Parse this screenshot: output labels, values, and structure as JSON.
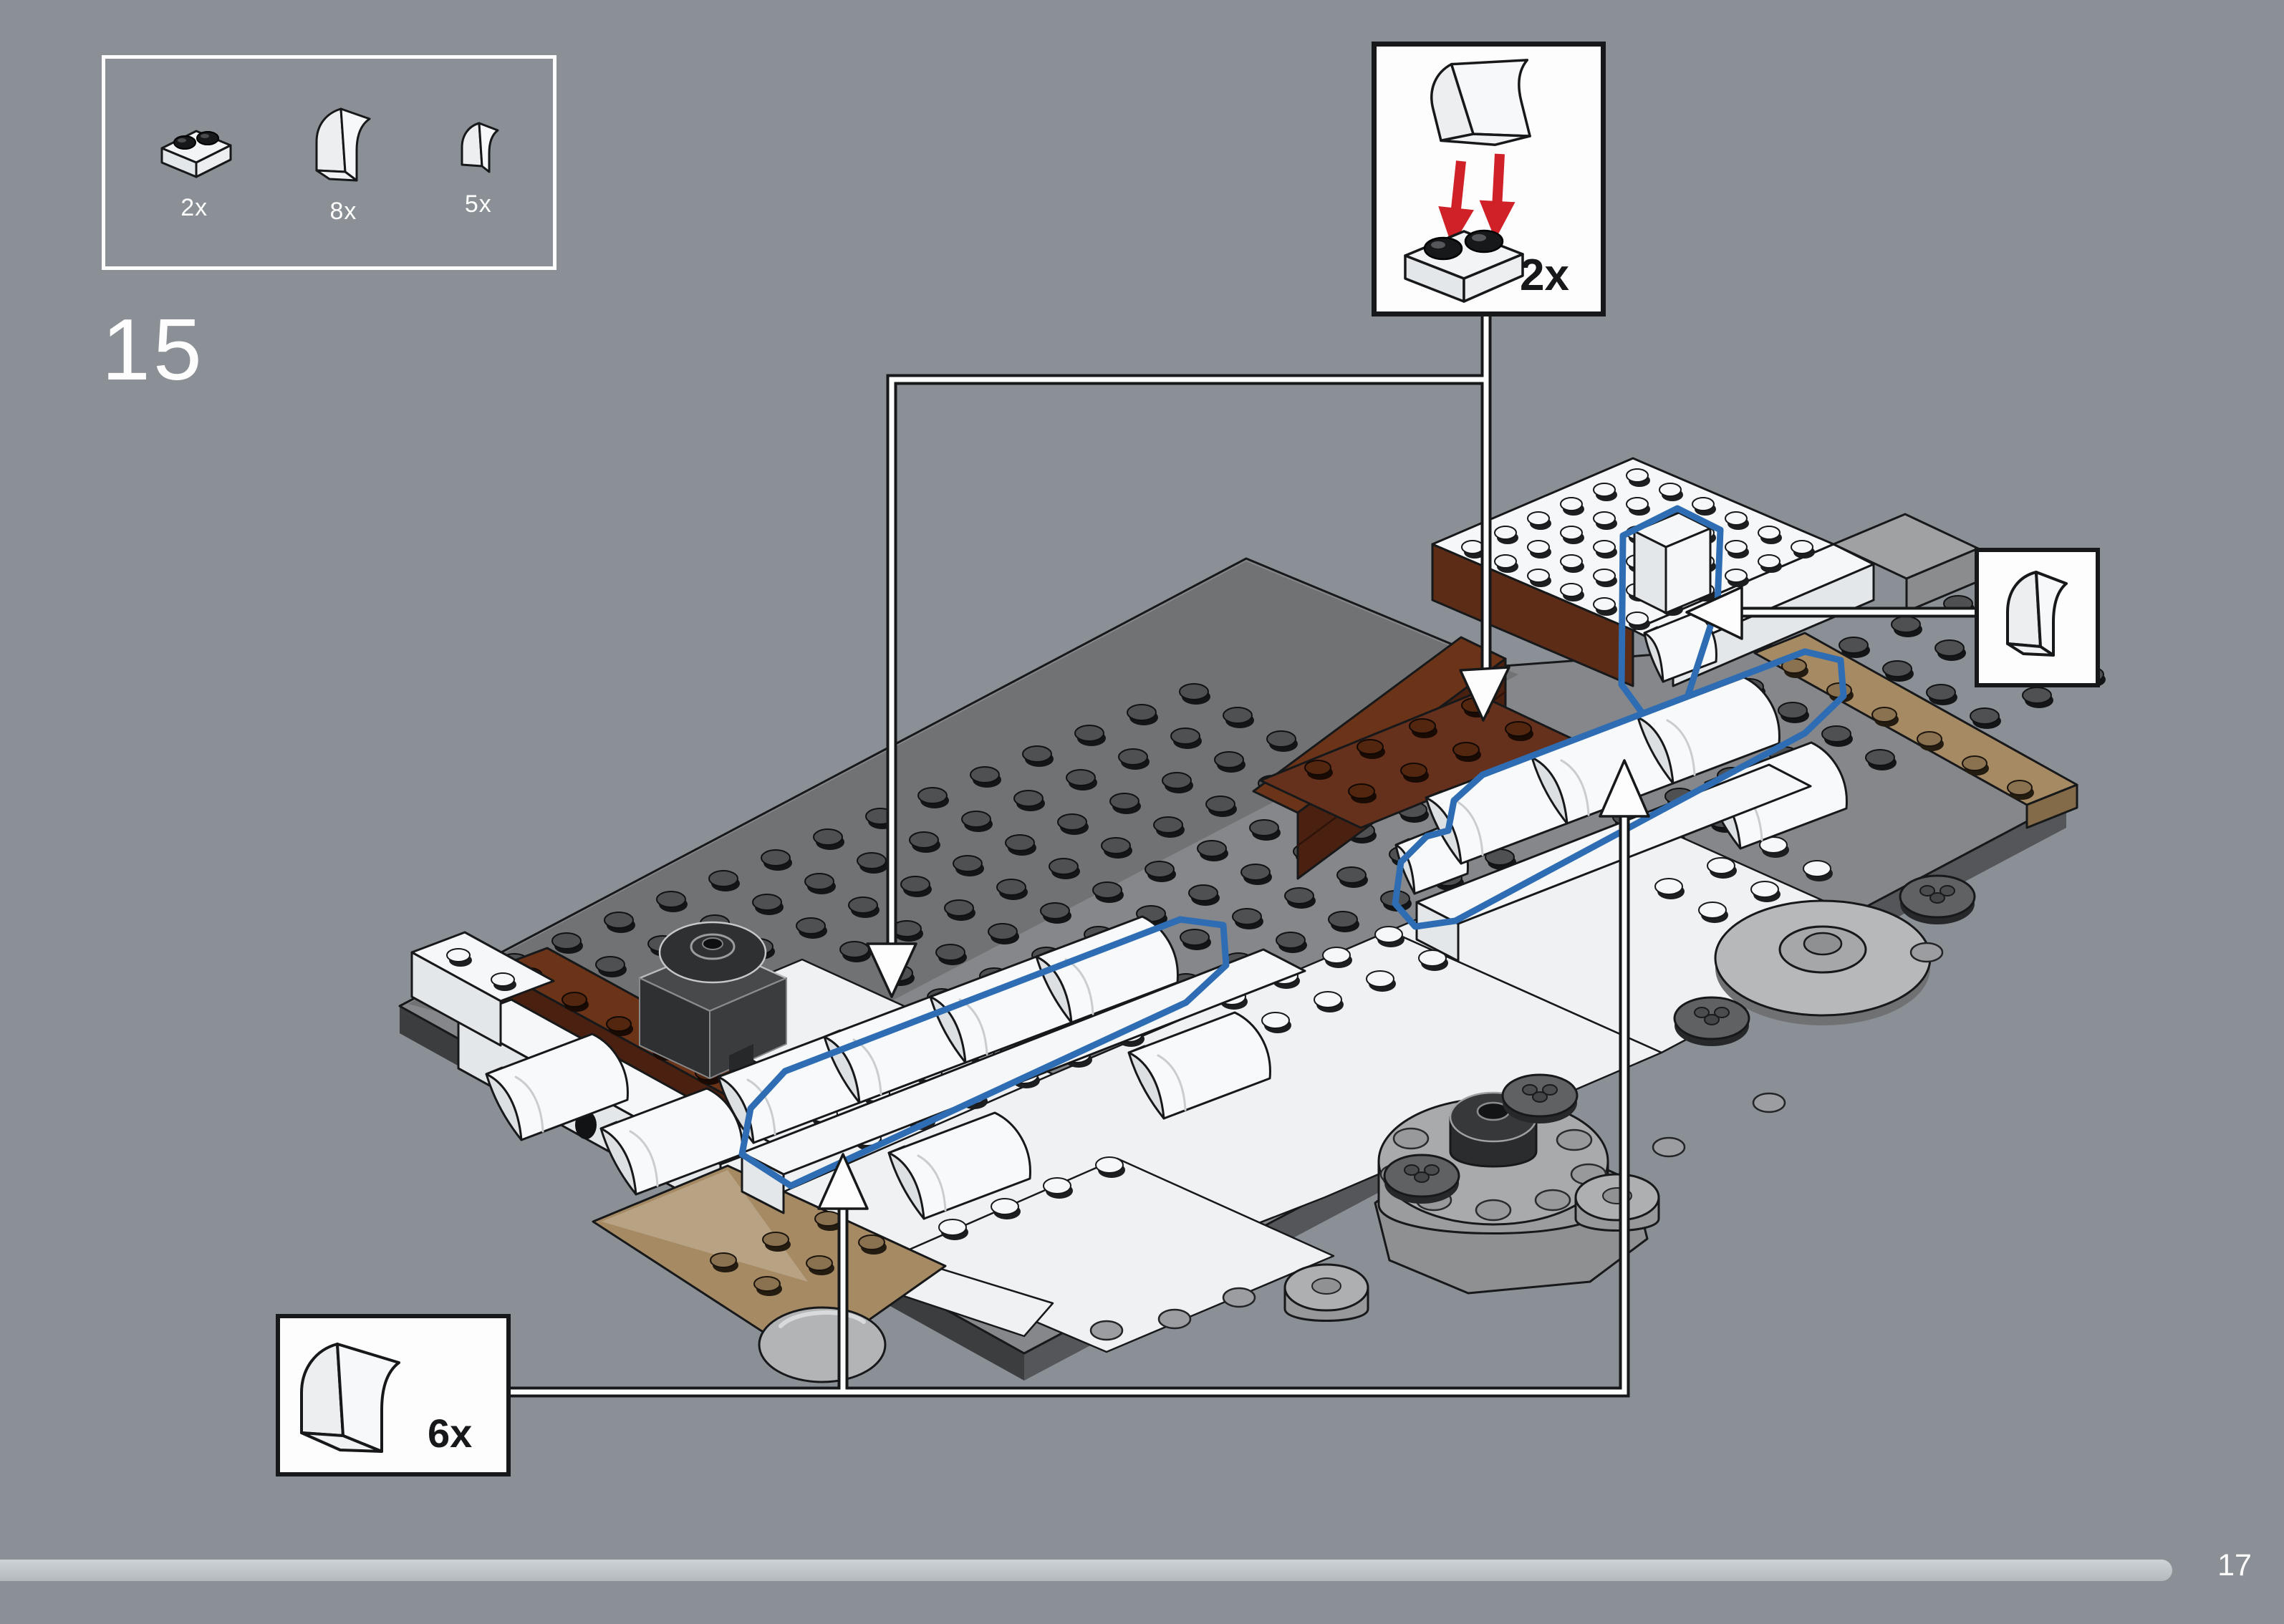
{
  "page": {
    "step_number": "15",
    "page_number": "17"
  },
  "parts_box": {
    "items": [
      {
        "icon": "plate-1x2-black-studs-icon",
        "count_label": "2x"
      },
      {
        "icon": "slope-curved-2x1-icon",
        "count_label": "8x"
      },
      {
        "icon": "slope-curved-1x1-icon",
        "count_label": "5x"
      }
    ]
  },
  "callouts": {
    "assembly_top_right": {
      "count_label": "2x",
      "icons": [
        "slope-curved-2x1-icon",
        "red-arrow-down-icon",
        "plate-1x2-black-studs-icon"
      ]
    },
    "piece_right": {
      "icons": [
        "slope-curved-1x1-icon"
      ]
    },
    "piece_bottom_left": {
      "count_label": "6x",
      "icons": [
        "slope-curved-2x1-icon"
      ]
    }
  },
  "progress": {
    "value_fraction": 0.951
  },
  "colors": {
    "bg": "#8a9095",
    "line_black": "#17181a",
    "label_dark": "#17181a",
    "blue_highlight": "#2e6db4",
    "red_arrow": "#cf2127",
    "plate_top": "#85878a",
    "plate_top_dark": "#707274",
    "plate_side": "#3b3d3f",
    "white_top": "#f5f7f8",
    "white_side": "#e4e7e9",
    "brown_top": "#6b3419",
    "brown_side": "#4a2110",
    "tan_top": "#a68a64",
    "tan_light": "#b7a384",
    "turret_gray": "#a8aaac",
    "turret_dark": "#36383a",
    "progress": "#c2c7cb",
    "progress_hi": "#ced3d7",
    "progress_lo": "#b4b9bd"
  }
}
